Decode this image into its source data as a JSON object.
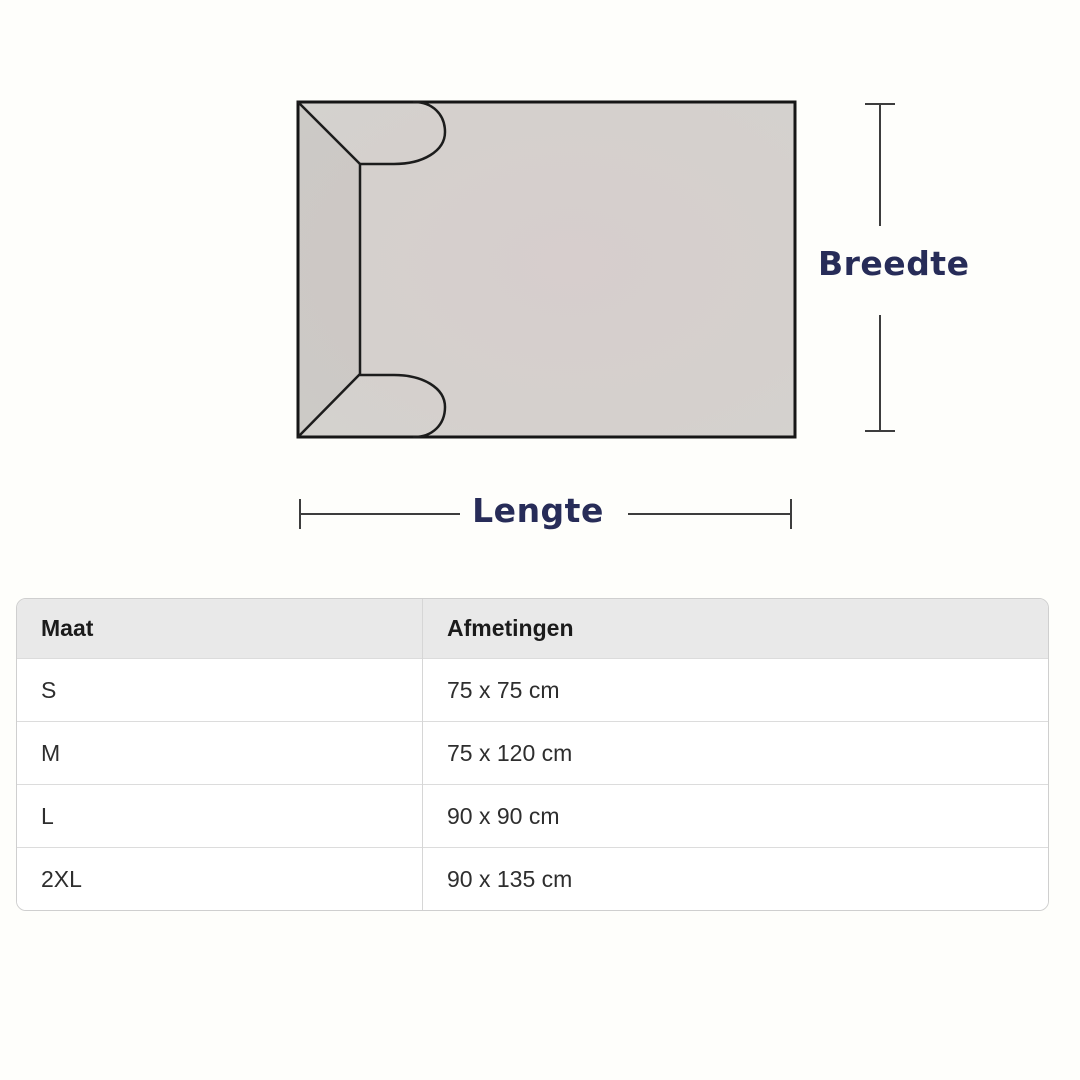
{
  "diagram": {
    "width_label": "Breedte",
    "length_label": "Lengte",
    "colors": {
      "label_accent": "#272c58",
      "blanket_fill_center": "#d7cecd",
      "blanket_fill_edge": "#d4d2ce",
      "outline": "#161616",
      "measure_line": "#3d3d3d"
    }
  },
  "table": {
    "headers": [
      "Maat",
      "Afmetingen"
    ],
    "rows": [
      {
        "maat": "S",
        "afmetingen": "75 x 75 cm"
      },
      {
        "maat": "M",
        "afmetingen": "75 x 120 cm"
      },
      {
        "maat": "L",
        "afmetingen": "90 x 90 cm"
      },
      {
        "maat": "2XL",
        "afmetingen": "90 x 135 cm"
      }
    ]
  }
}
